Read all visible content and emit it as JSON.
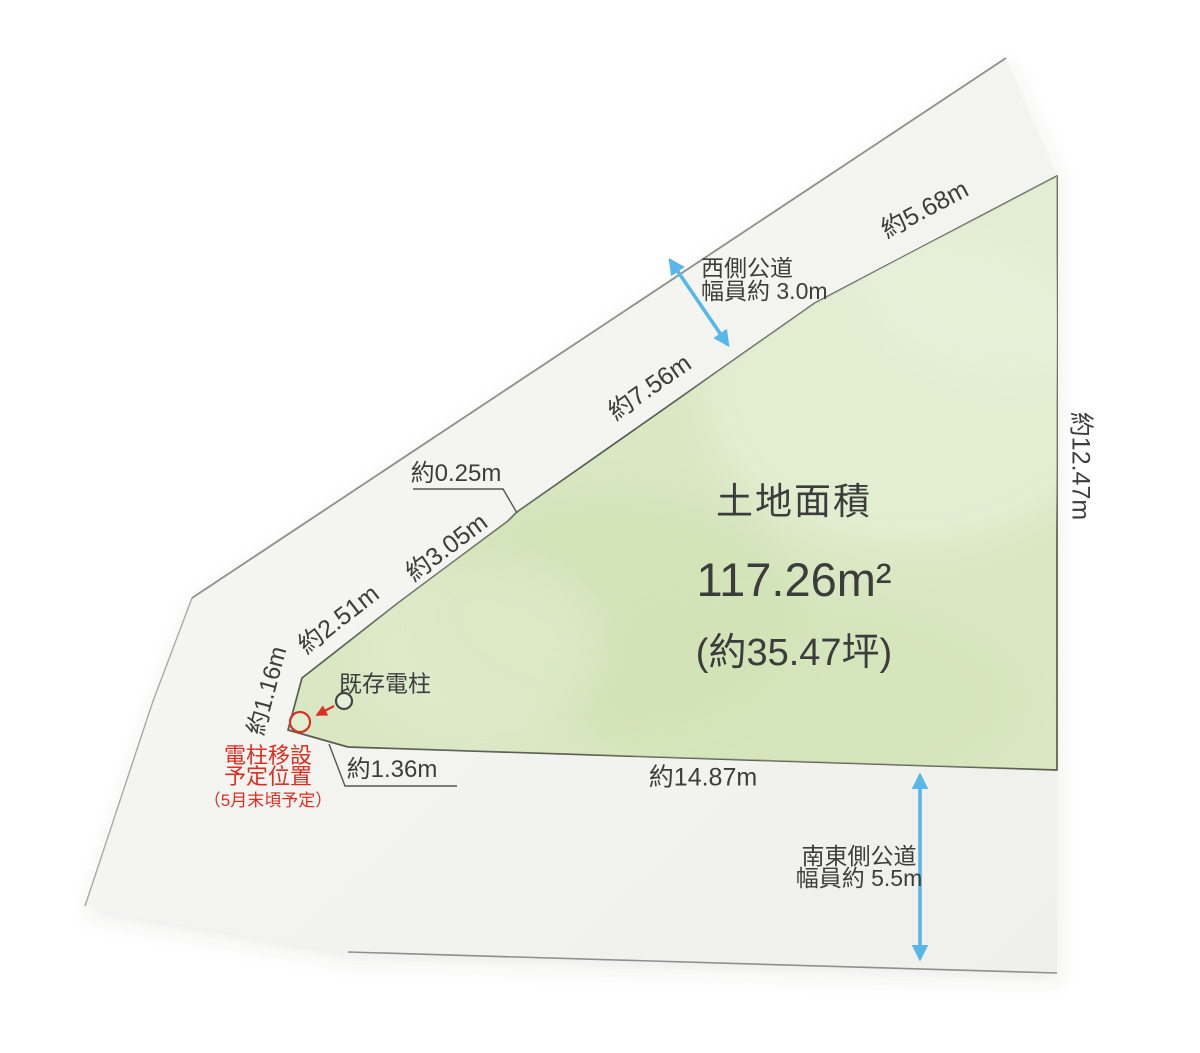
{
  "diagram": {
    "area": {
      "title": "土地面積",
      "size_sqm": "117.26m²",
      "size_tsubo": "(約35.47坪)"
    },
    "dims": {
      "d568": "約5.68m",
      "d756": "約7.56m",
      "d025": "約0.25m",
      "d305": "約3.05m",
      "d251": "約2.51m",
      "d116": "約1.16m",
      "d136": "約1.36m",
      "d1487": "約14.87m",
      "d1247": "約12.47m"
    },
    "roads": {
      "west": {
        "line1": "西側公道",
        "line2": "幅員約 3.0m"
      },
      "southeast": {
        "line1": "南東側公道",
        "line2": "幅員約 5.5m"
      }
    },
    "poles": {
      "existing_label": "既存電柱",
      "relocation_line1": "電柱移設",
      "relocation_line2": "予定位置",
      "relocation_line3": "（5月末頃予定）"
    },
    "colors": {
      "land_fill": "#d9e8c3",
      "land_stroke": "#595d52",
      "road_fill": "#f3f3f1",
      "outline_gray": "#8f8f8f",
      "arrow_blue": "#56b7e8",
      "accent_red": "#dc2f23",
      "text": "#3d3d3d"
    }
  }
}
